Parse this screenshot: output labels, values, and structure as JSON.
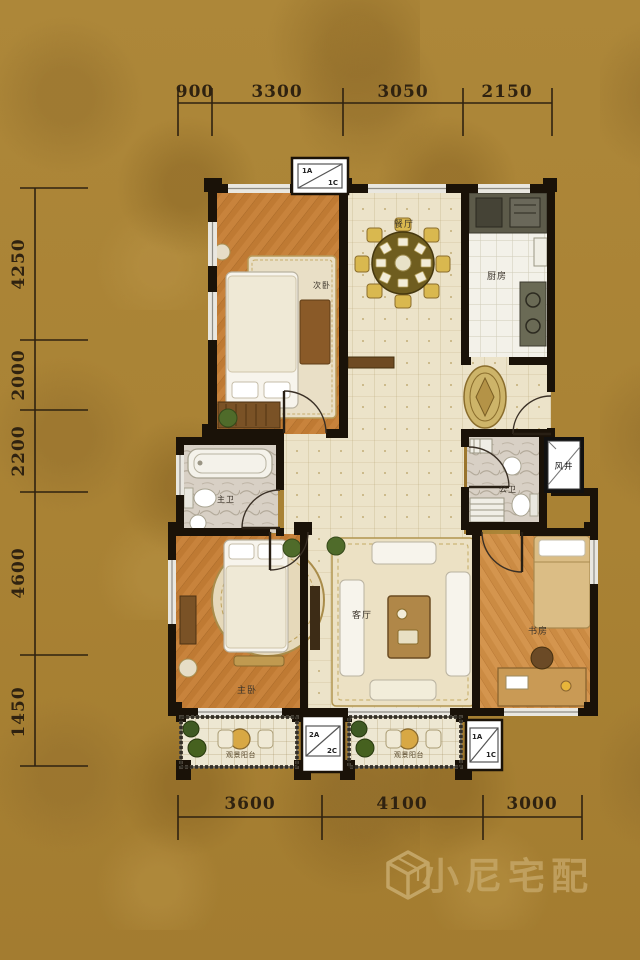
{
  "dimensions": {
    "top": [
      "900",
      "3300",
      "3050",
      "2150"
    ],
    "left": [
      "4250",
      "2000",
      "2200",
      "4600",
      "1450"
    ],
    "bottom": [
      "3600",
      "4100",
      "3000"
    ]
  },
  "rooms": {
    "bedroom2": "次卧",
    "dining": "餐厅",
    "kitchen": "厨房",
    "master_bath": "主卫",
    "public_bath": "公卫",
    "air_shaft": "风井",
    "master_bedroom": "主卧",
    "living": "客厅",
    "study": "书房",
    "balcony_left": "观景阳台",
    "balcony_right": "观景阳台"
  },
  "ac_units": {
    "top": {
      "a": "1A",
      "c": "1C"
    },
    "bottom_mid": {
      "a": "2A",
      "c": "2C"
    },
    "bottom_right": {
      "a": "1A",
      "c": "1C"
    }
  },
  "watermark": {
    "text": "小尼宅配"
  },
  "colors": {
    "background": "#aa8336",
    "wall": "#1a1208",
    "wood_floor": "#c8833c",
    "cream_tile": "#ece3c9",
    "white_tile": "#f3f1e9",
    "marble": "#d8d0c5",
    "dim_text": "#2f2210",
    "watermark": "#c9ac6f"
  }
}
